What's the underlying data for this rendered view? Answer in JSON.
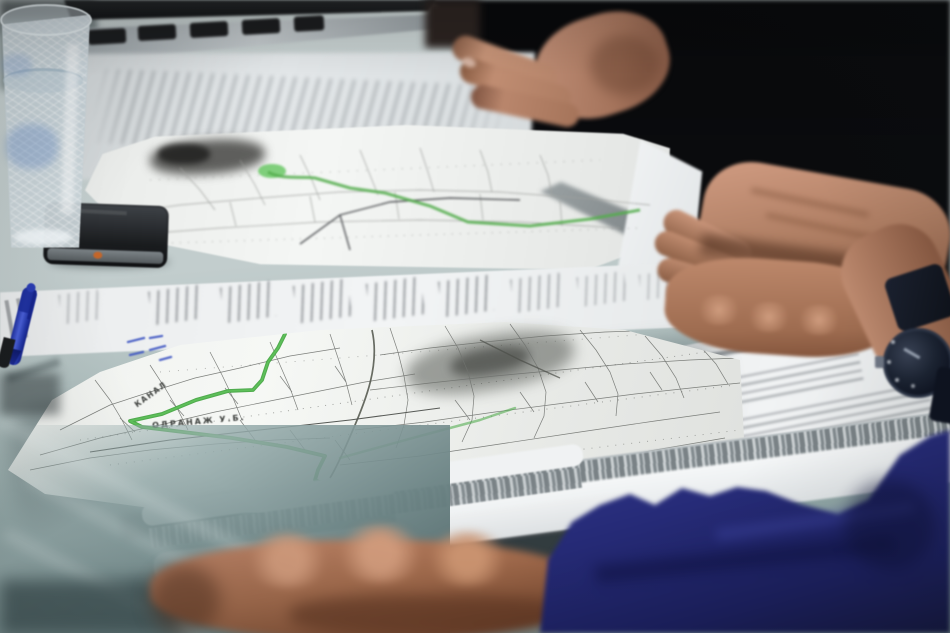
{
  "photo": {
    "labels": {
      "foreground_map_primary": "ОДРАНАЖ У.Б.",
      "foreground_map_secondary": "КАНАЛ"
    },
    "colors": {
      "route-green": "#47a844",
      "route-green-light": "#63c55e",
      "route-green-upper": "#53ad4c",
      "table-base": "#bcc9c8",
      "sleeve-navy": "#262b78",
      "pen-blue": "#2d41b8",
      "paper-white": "#f2f4f5",
      "skin-tone": "#b9866a",
      "dark-clothing": "#0a0b0e",
      "handwriting-blue": "#3c54c2"
    }
  }
}
